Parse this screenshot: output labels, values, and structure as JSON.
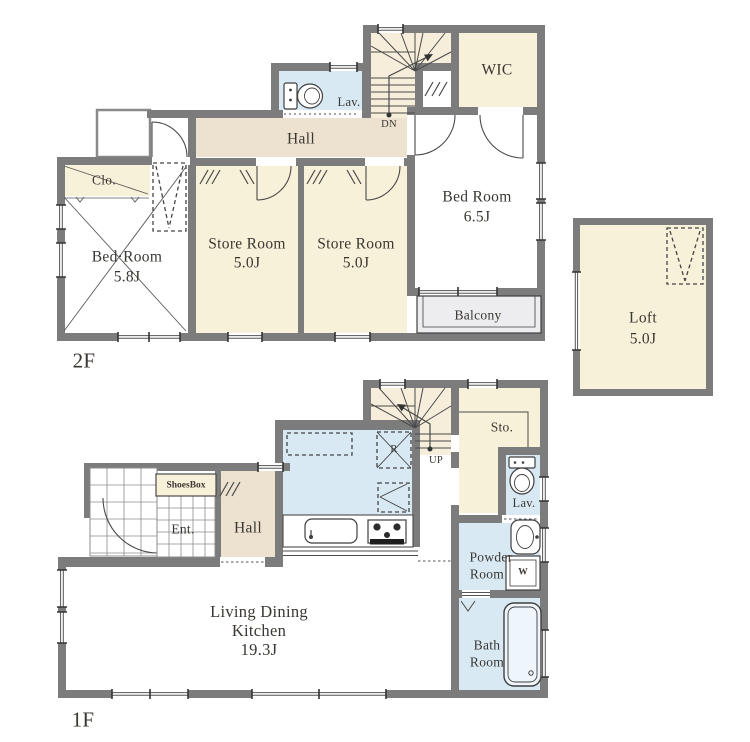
{
  "palette": {
    "wall": "#7c7c7c",
    "room_cream": "#f8f1da",
    "hall_beige": "#ece2cf",
    "water_blue": "#d9e9f4",
    "balcony_gray": "#ededf0",
    "stair_cream": "#f6eedb",
    "line": "#4a4a4a",
    "text": "#3a3732"
  },
  "floor2": {
    "label": "2F",
    "rooms": {
      "closet": "Clo.",
      "bedroom_small": {
        "name": "Bed·Room",
        "size": "5.8J"
      },
      "store1": {
        "name": "Store Room",
        "size": "5.0J"
      },
      "store2": {
        "name": "Store Room",
        "size": "5.0J"
      },
      "hall": "Hall",
      "lavatory": "Lav.",
      "stairs_dir": "DN",
      "wic": "WIC",
      "bedroom_main": {
        "name": "Bed Room",
        "size": "6.5J"
      },
      "balcony": "Balcony"
    }
  },
  "loft": {
    "name": "Loft",
    "size": "5.0J"
  },
  "floor1": {
    "label": "1F",
    "rooms": {
      "stairs_dir": "UP",
      "storage": "Sto.",
      "lavatory": "Lav.",
      "refrigerator": "R",
      "shoes_box": "ShoesBox",
      "entrance": "Ent.",
      "hall": "Hall",
      "ldk": {
        "line1": "Living Dining",
        "line2": "Kitchen",
        "size": "19.3J"
      },
      "powder": {
        "line1": "Powder",
        "line2": "Room"
      },
      "washer": "W",
      "bath": {
        "line1": "Bath",
        "line2": "Room"
      }
    }
  }
}
